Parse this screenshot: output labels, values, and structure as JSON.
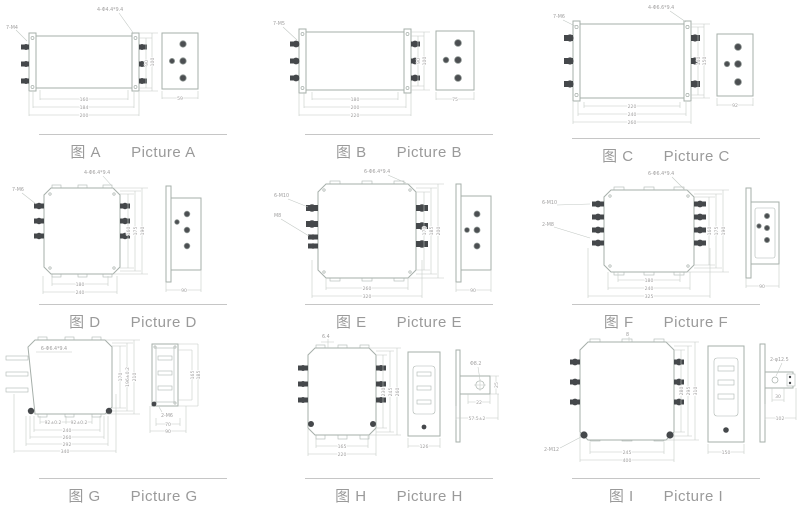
{
  "colors": {
    "drawing_line": "#a6afaa",
    "dimension_text": "#a09f9f",
    "terminal_dark": "#45484b",
    "caption_text": "#9a9a9a"
  },
  "pictures": [
    {
      "id": "A",
      "caption_cn": "图 A",
      "caption_en": "Picture A",
      "labels": {
        "left": "7-M4",
        "top": "4-Φ4.4*9.4"
      },
      "dims": {
        "widths": [
          "160",
          "184",
          "200"
        ],
        "heights": [
          "90",
          "100"
        ],
        "side_width": "59"
      }
    },
    {
      "id": "B",
      "caption_cn": "图 B",
      "caption_en": "Picture B",
      "labels": {
        "left": "7-M5"
      },
      "dims": {
        "widths": [
          "180",
          "200",
          "220"
        ],
        "heights": [
          "90",
          "100"
        ],
        "side_width": "75"
      }
    },
    {
      "id": "C",
      "caption_cn": "图 C",
      "caption_en": "Picture C",
      "labels": {
        "left": "7-M6",
        "top": "4-Φ6.6*9.4"
      },
      "dims": {
        "widths": [
          "220",
          "240",
          "260"
        ],
        "heights": [
          "140",
          "150"
        ],
        "side_width": "92"
      }
    },
    {
      "id": "D",
      "caption_cn": "图 D",
      "caption_en": "Picture D",
      "labels": {
        "left": "7-M6",
        "top": "4-Φ6.4*9.4"
      },
      "dims": {
        "widths": [
          "180",
          "240"
        ],
        "heights": [
          "160",
          "175",
          "190"
        ],
        "side_width": "90"
      }
    },
    {
      "id": "E",
      "caption_cn": "图 E",
      "caption_en": "Picture E",
      "labels": {
        "left": "6-M10",
        "left2": "M8",
        "top": "6-Φ6.4*9.4"
      },
      "dims": {
        "widths": [
          "260",
          "320"
        ],
        "heights": [
          "170",
          "185",
          "200"
        ],
        "side_width": "90"
      }
    },
    {
      "id": "F",
      "caption_cn": "图 F",
      "caption_en": "Picture F",
      "labels": {
        "left": "6-M10",
        "left2": "2-M8",
        "top": "6-Φ6.4*9.4"
      },
      "dims": {
        "widths": [
          "180",
          "240",
          "325"
        ],
        "heights": [
          "160",
          "175",
          "190"
        ],
        "side_width": "90"
      }
    },
    {
      "id": "G",
      "caption_cn": "图 G",
      "caption_en": "Picture G",
      "labels": {
        "top": "6-Φ6.4*9.4",
        "side": "2-M6"
      },
      "dims": {
        "widths": [
          "92±0.2",
          "92±0.2",
          "240",
          "260",
          "292",
          "340"
        ],
        "heights": [
          "170",
          "196±0.2",
          "210"
        ],
        "side_widths": [
          "70",
          "90"
        ],
        "side_heights": [
          "165",
          "185"
        ]
      }
    },
    {
      "id": "H",
      "caption_cn": "图 H",
      "caption_en": "Picture H",
      "labels": {
        "top": "6.4",
        "hole": "Φ8.2"
      },
      "dims": {
        "widths": [
          "165",
          "220"
        ],
        "heights": [
          "230",
          "245",
          "260"
        ],
        "mid_width": "126",
        "bracket_height": "25",
        "bracket_offset": "22",
        "bracket_pitch": "57.5±2"
      }
    },
    {
      "id": "I",
      "caption_cn": "图 I",
      "caption_en": "Picture I",
      "labels": {
        "top": "8",
        "corner": "2-M12",
        "hole": "2-φ12.5"
      },
      "dims": {
        "widths": [
          "245",
          "400"
        ],
        "heights": [
          "280",
          "295",
          "310"
        ],
        "mid_width": "150",
        "bracket_offset": "30",
        "bracket_pitch": "102"
      }
    }
  ]
}
